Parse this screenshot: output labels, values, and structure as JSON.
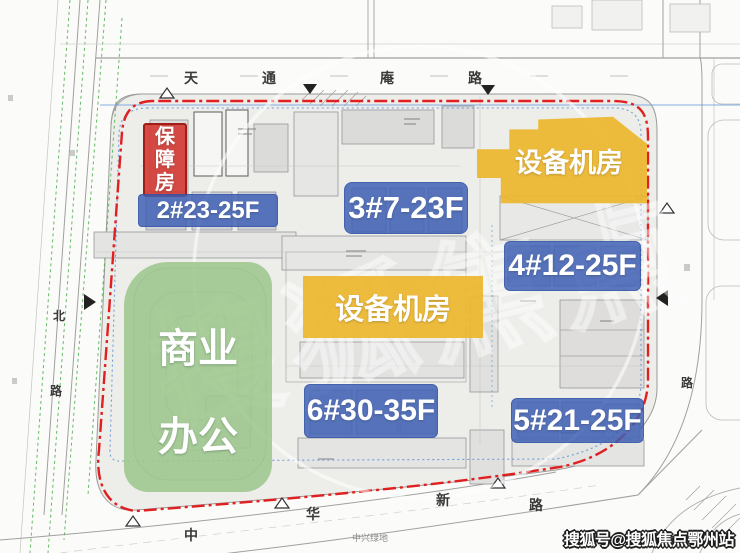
{
  "site_plan": {
    "roads": {
      "top": {
        "name": "天通庵路",
        "chars": [
          "天",
          "通",
          "庵",
          "路"
        ]
      },
      "bottom": {
        "name": "中华新路",
        "chars": [
          "中",
          "华",
          "新",
          "路"
        ]
      },
      "left": {
        "chars": [
          "北",
          "路"
        ]
      },
      "right": {
        "chars": [
          "路"
        ]
      }
    },
    "green_space_label": "中兴绿地",
    "labels": {
      "affordable_housing": "保障房",
      "building_2": "2#23-25F",
      "building_3": "3#7-23F",
      "building_4": "4#12-25F",
      "building_5": "5#21-25F",
      "building_6": "6#30-35F",
      "equipment_room_top": "设备机房",
      "equipment_room_mid": "设备机房",
      "commercial_office_line1": "商业",
      "commercial_office_line2": "办公"
    },
    "colors": {
      "residential_label_blue": "#3e5fb4",
      "equipment_label_yellow": "#edb62c",
      "commercial_label_green": "#9dc78d",
      "affordable_label_red": "#d33932",
      "boundary_red_line": "#e02020",
      "boundary_blue_line": "#5b8fd6",
      "tree_line_green": "#44aa44"
    }
  },
  "watermark": {
    "center": "搜狐焦点",
    "bottom_right": "搜狐号@搜狐焦点鄂州站"
  }
}
